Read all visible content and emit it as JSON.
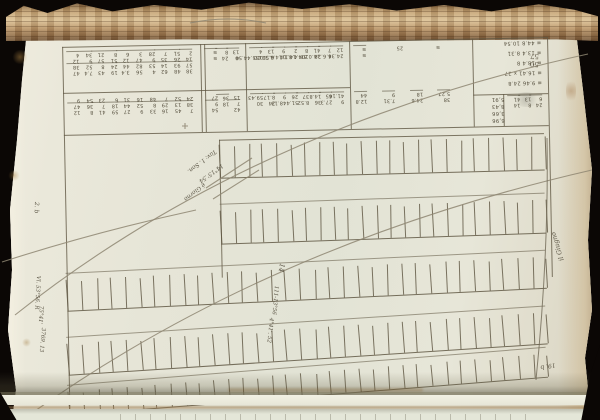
{
  "scene": {
    "background_color": "#0b0705",
    "page_color": "#e9e7da",
    "page_stack_edge_color": "#b8946a",
    "ink_color": "#5a5342",
    "faint_ink_color": "#8e8672",
    "rust_stain_color": "#a97b4a",
    "description": "photograph of an open manuscript book, page of ruled astronomical tables shown upside down"
  },
  "folio": {
    "top": "57",
    "bottom": "50"
  },
  "notes": {
    "corner": "2. b",
    "center": [
      "Tav: 1. Son.",
      "14°15'.54",
      "é Giorno"
    ],
    "left_margin": [
      "Vl. 53°56. R",
      "75°41'",
      "3769. 13"
    ],
    "mid_grid": [
      "14",
      "111-13°56",
      "4°41'. 52"
    ],
    "right_margin": "il Giugno",
    "bottom_right": "19. b"
  },
  "top_tables": {
    "panels": [
      {
        "id": "a",
        "x0": 8,
        "x1": 146,
        "upper": [
          "47 38 12 4",
          "7.4 52 9 34",
          "43 8 57 21",
          "19 24 51 8",
          "3.4 44 12 6",
          "56 82 47 3",
          "4 53 9 28",
          "62 14 35 7",
          "48 93 26 51",
          "38 57 14 2"
        ],
        "lower": [
          "12 47 9",
          "8 36 54",
          "41 7 23",
          "59 18 6",
          "27 44 31",
          "9 52 16",
          "33 8 48",
          "16 29 7",
          "45 13 52",
          "7 38 24"
        ]
      },
      {
        "id": "b",
        "x0": 146,
        "x1": 191,
        "upper": [
          "≡ ≡",
          "24 8",
          "≡ 13"
        ],
        "lower": [
          "54 9 27",
          "18 36",
          "42 7 15"
        ]
      },
      {
        "id": "c",
        "x0": 191,
        "x1": 295,
        "upper": [
          "155.44.50 4",
          "6.51.00 13",
          "114.4.38 9",
          "4.8.14 2",
          "104.14.1 8",
          "14.0.58 41",
          "4.6.28 7",
          "24.36 12"
        ],
        "lower": [
          "30 59.43",
          "24 8.17",
          "48.13 9",
          "51.4 26",
          "8.52 37",
          "36 14.8",
          "27.3 45",
          "9 41.16"
        ]
      },
      {
        "id": "d",
        "x0": 295,
        "x1": 418,
        "upper": [
          "≡ ≡",
          "25",
          "≡"
        ],
        "lower": [
          "12.8 44",
          "7.31 9",
          "24.6 18",
          "38 5.27"
        ]
      },
      {
        "id": "e",
        "x0": 418,
        "x1": 493,
        "rows": [
          "≡ 44.8 10.54",
          "≡ 13.4 8.31",
          "≡ 18.4 8",
          "≡ 16.41 x 27",
          "≡ 9.46 24.8"
        ],
        "box": [
          "5,91",
          "8,43",
          "3,66",
          "6,96"
        ],
        "box2": [
          "14.41",
          "8.13",
          "24.6"
        ]
      }
    ]
  },
  "grid": {
    "lines": [
      {
        "x0": 8,
        "y0": 6,
        "x1": 493,
        "y1": 6
      },
      {
        "x0": 8,
        "y0": 52,
        "x1": 295,
        "y1": 52
      },
      {
        "x0": 8,
        "y0": 94,
        "x1": 493,
        "y1": 94
      },
      {
        "x0": 163,
        "y0": 102,
        "x1": 488,
        "y1": 102
      },
      {
        "x0": 418,
        "y0": 62,
        "x1": 493,
        "y1": 62
      }
    ],
    "verticals": [
      {
        "x": 8,
        "y0": 6,
        "y1": 368
      },
      {
        "x": 146,
        "y0": 6,
        "y1": 94
      },
      {
        "x": 150,
        "y0": 6,
        "y1": 94
      },
      {
        "x": 191,
        "y0": 6,
        "y1": 94
      },
      {
        "x": 295,
        "y0": 6,
        "y1": 94
      },
      {
        "x": 418,
        "y0": 6,
        "y1": 94
      },
      {
        "x": 448,
        "y0": 62,
        "y1": 94
      },
      {
        "x": 493,
        "y0": 6,
        "y1": 246
      },
      {
        "x": 163,
        "y0": 102,
        "y1": 240
      }
    ],
    "comb_rows": [
      {
        "x0": 163,
        "x1": 488,
        "yTop": 106,
        "yBase": 140,
        "ticks": 23,
        "rot": -0.3
      },
      {
        "x0": 163,
        "x1": 488,
        "yTop": 172,
        "yBase": 206,
        "ticks": 23,
        "rot": -0.8,
        "preline": 166
      },
      {
        "x0": 8,
        "x1": 488,
        "yTop": 238,
        "yBase": 270,
        "ticks": 33,
        "rot": -1.6,
        "preline": 232
      },
      {
        "x0": 8,
        "x1": 488,
        "yTop": 302,
        "yBase": 334,
        "ticks": 33,
        "rot": -2.6,
        "preline": 296
      },
      {
        "x0": 8,
        "x1": 488,
        "yTop": 350,
        "yBase": 374,
        "ticks": 33,
        "rot": -3.4,
        "preline": 344
      }
    ]
  },
  "arcs": {
    "paths": [
      "M 15 315 Q 250 128 588 54",
      "M 25 418 Q 265 245 592 170",
      "M 2 262 Q 95 232 196 210",
      "M 190 23 Q 228 15 266 23",
      "M 206 188 L 252 158",
      "M 213 199 L 259 170",
      "M 182 126 L 188 126 M 185 123 L 185 129"
    ],
    "grid_border_paths": [
      "M 547 138 Q 549 250 536 380"
    ]
  }
}
